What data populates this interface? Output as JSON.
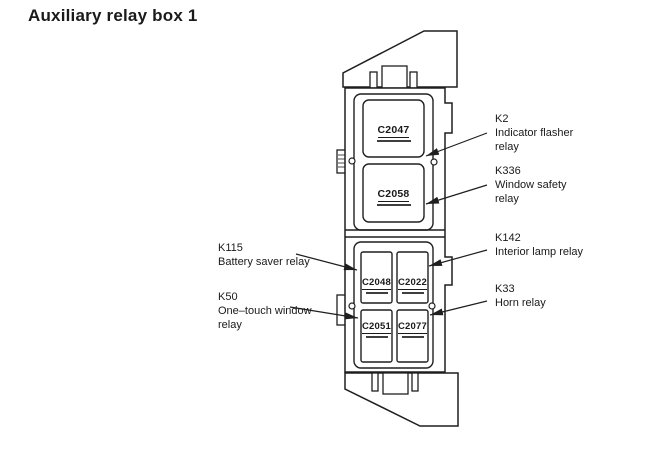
{
  "page": {
    "title": "Auxiliary relay box 1"
  },
  "diagram": {
    "type": "relay-box-diagram",
    "relays_large": [
      {
        "id": "C2047"
      },
      {
        "id": "C2058"
      }
    ],
    "relays_small": [
      {
        "id": "C2048"
      },
      {
        "id": "C2022"
      },
      {
        "id": "C2051"
      },
      {
        "id": "C2077"
      }
    ],
    "callouts_right": [
      {
        "code": "K2",
        "line1": "Indicator flasher",
        "line2": "relay"
      },
      {
        "code": "K336",
        "line1": "Window safety",
        "line2": "relay"
      },
      {
        "code": "K142",
        "line1": "Interior lamp relay"
      },
      {
        "code": "K33",
        "line1": "Horn relay"
      }
    ],
    "callouts_left": [
      {
        "code": "K115",
        "line1": "Battery saver relay"
      },
      {
        "code": "K50",
        "line1": "One–touch window",
        "line2": "relay"
      }
    ],
    "colors": {
      "line": "#1f1f1f",
      "background": "#ffffff"
    }
  }
}
